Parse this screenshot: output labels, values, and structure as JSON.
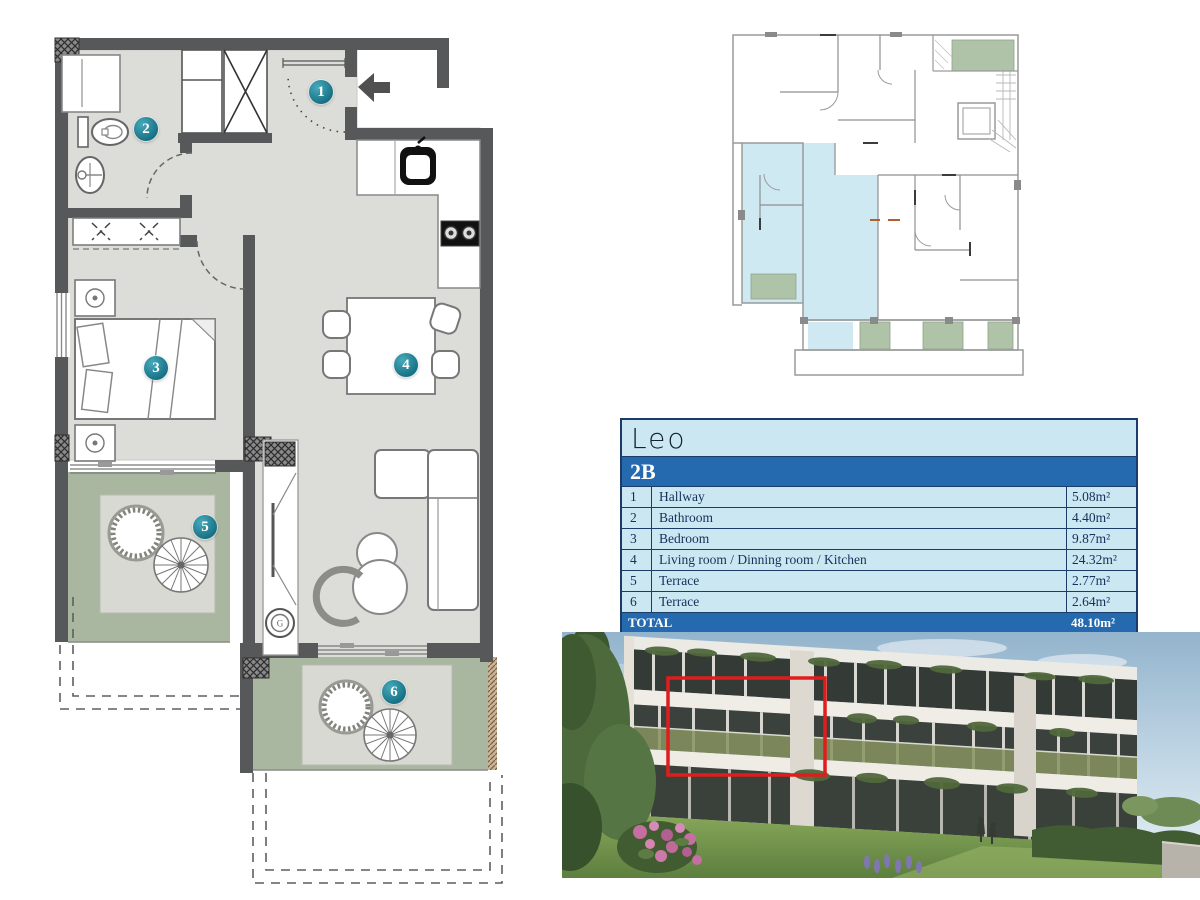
{
  "brand": {
    "logo": "Leo"
  },
  "unit": {
    "code": "2B"
  },
  "table": {
    "rooms": [
      {
        "num": "1",
        "name": "Hallway",
        "area": "5.08m²"
      },
      {
        "num": "2",
        "name": "Bathroom",
        "area": "4.40m²"
      },
      {
        "num": "3",
        "name": "Bedroom",
        "area": "9.87m²"
      },
      {
        "num": "4",
        "name": "Living room / Dinning room / Kitchen",
        "area": "24.32m²"
      },
      {
        "num": "5",
        "name": "Terrace",
        "area": "2.77m²"
      },
      {
        "num": "6",
        "name": "Terrace",
        "area": "2.64m²"
      }
    ],
    "total_label": "TOTAL",
    "total_area": "48.10m²"
  },
  "floorplan": {
    "boiler_label": "G"
  },
  "colors": {
    "wall": "#57585a",
    "floor": "#dcdcd8",
    "terrace": "#a9b7a0",
    "pad": "#d9d9d4",
    "table_light": "#cbe7f2",
    "table_dark": "#2569ae",
    "table_border": "#1b3c68",
    "table_text": "#143159",
    "badge": "#177184",
    "badge_light": "#46aabb",
    "site_blue": "#cfe9f3",
    "site_green": "#aec3a8",
    "site_wall": "#9a9a9a",
    "red_box": "#e01d1d",
    "lawn": "#7f9e52",
    "sky": "#a9c6da"
  }
}
